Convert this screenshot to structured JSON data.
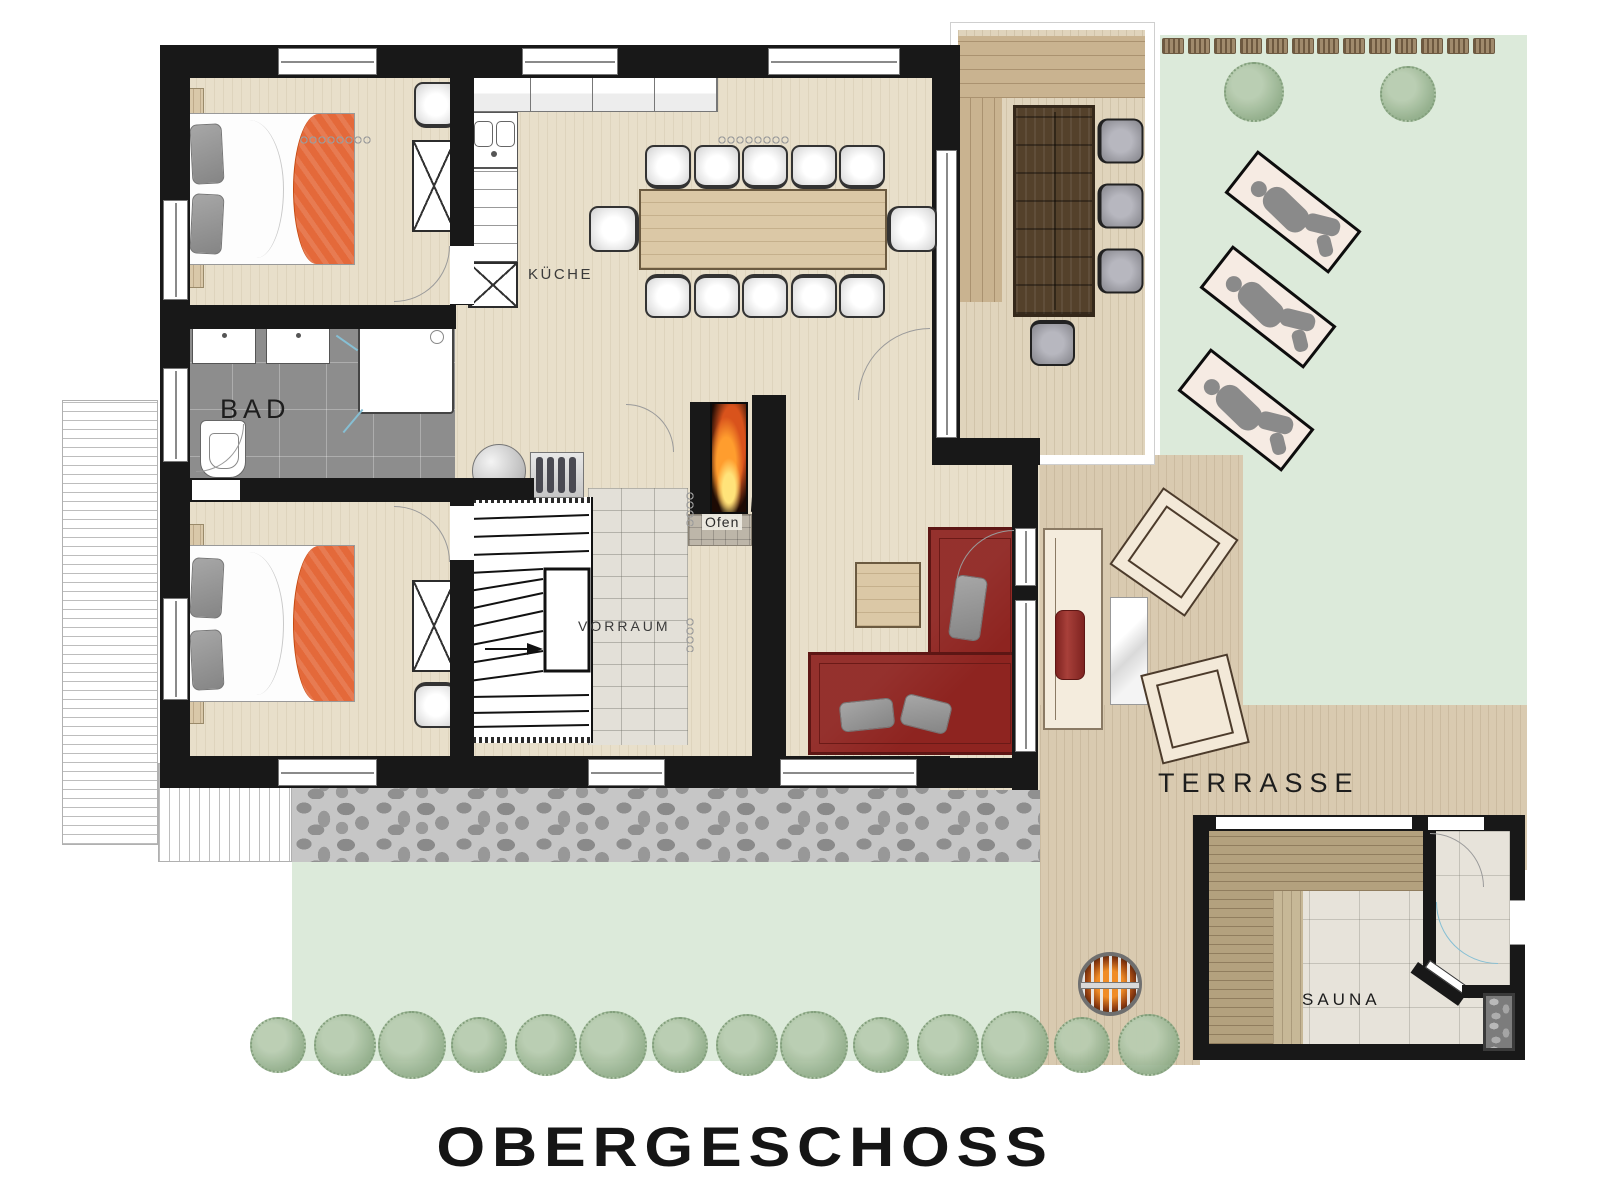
{
  "title": "OBERGESCHOSS",
  "labels": {
    "kitchen": "KÜCHE",
    "bath": "BAD",
    "vestibule": "VORRAUM",
    "stove": "Ofen",
    "terrace": "TERRASSE",
    "sauna": "SAUNA"
  },
  "colors": {
    "wall": "#181818",
    "floor": "#e8dfca",
    "floor_stripe": "rgba(139,112,77,0.10)",
    "deck": "#d9cab0",
    "deck_covered": "#e0d4bc",
    "lawn": "#dceada",
    "bath_floor": "#8d8d8d",
    "vorraum_tile": "#e3e0d8",
    "bed_blanket": "#e4693a",
    "sofa": "#8e2420",
    "wood_dark": "#54412b",
    "wood_light": "#dbc8a6",
    "glass": "#86bfd4",
    "bush": "#9cb795",
    "hedge": "#a08a6c",
    "stone_path": "#c6c6c6",
    "fire": "#ff9d2e"
  },
  "counts": {
    "bedrooms": 2,
    "dining_chairs": 12,
    "covered_terrace_chairs": 4,
    "sun_loungers": 3,
    "deck_lounge_chairs": 2,
    "bushes_bottom_row": 14,
    "bushes_lawn": 2,
    "hedge_blocks": 13
  }
}
